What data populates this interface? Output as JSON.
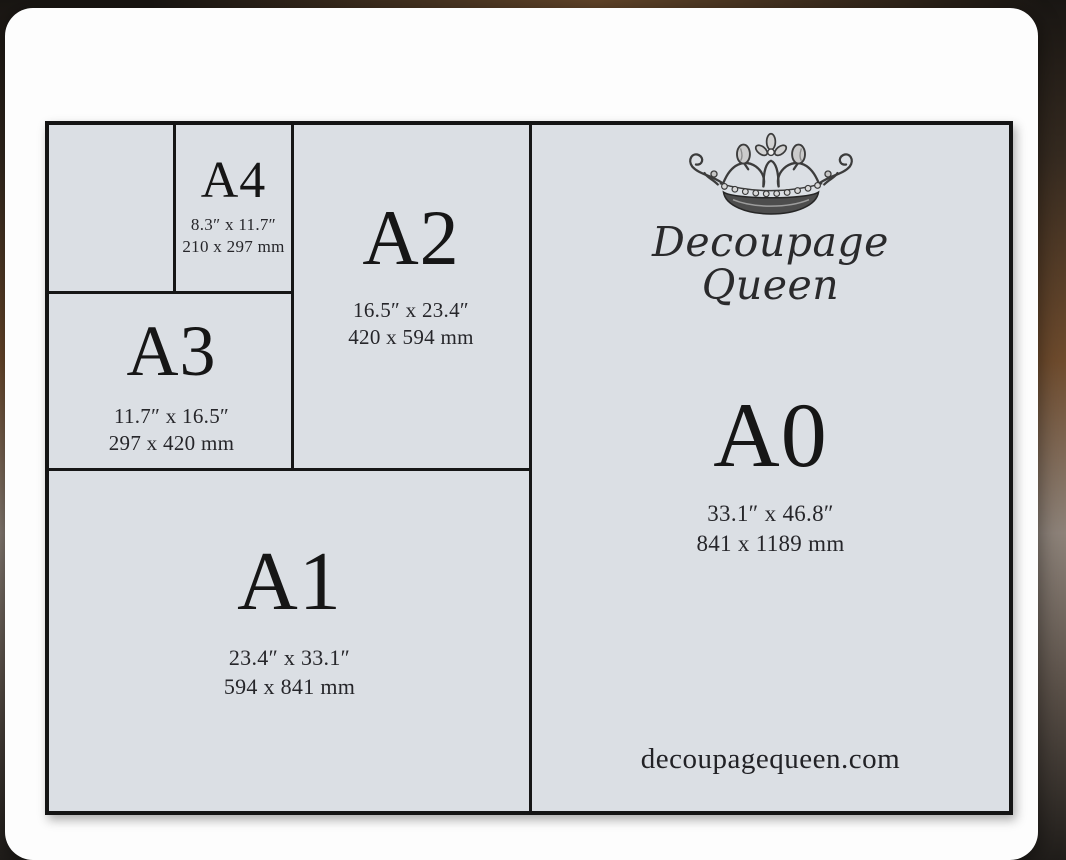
{
  "brand": {
    "name_line1": "Decoupage",
    "name_line2": "Queen",
    "website": "decoupagequeen.com",
    "crown_icon": "ornate-vintage-engraved-crown"
  },
  "colors": {
    "panel_background": "#dbdfe4",
    "grid_border": "#141414",
    "card_background": "#fdfdfd",
    "backdrop_brown": "#6e4b2d",
    "text": "#161616"
  },
  "sizes": {
    "a4": {
      "label": "A4",
      "inches": "8.3″ x 11.7″",
      "mm": "210 x 297 mm"
    },
    "a3": {
      "label": "A3",
      "inches": "11.7″ x 16.5″",
      "mm": "297 x 420 mm"
    },
    "a2": {
      "label": "A2",
      "inches": "16.5″ x 23.4″",
      "mm": "420 x 594 mm"
    },
    "a1": {
      "label": "A1",
      "inches": "23.4″ x 33.1″",
      "mm": "594 x 841 mm"
    },
    "a0": {
      "label": "A0",
      "inches": "33.1″ x 46.8″",
      "mm": "841 x 1189 mm"
    }
  }
}
